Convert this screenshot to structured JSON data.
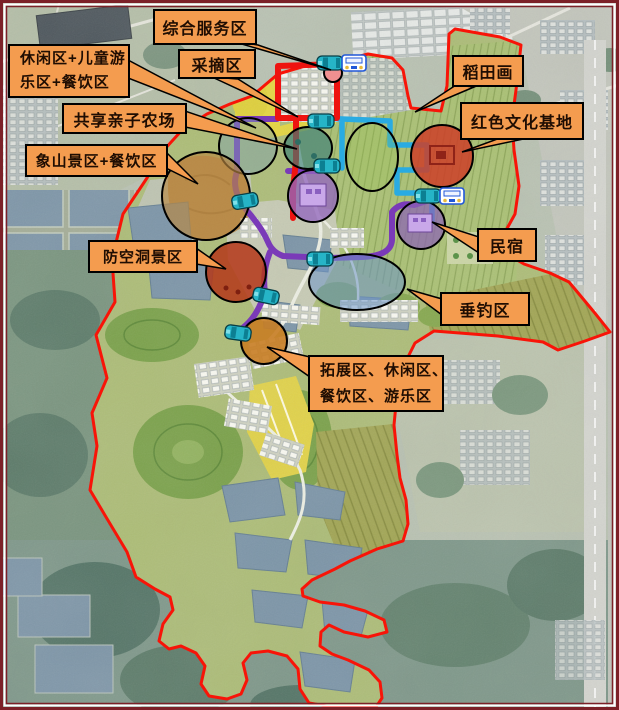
{
  "callouts": [
    {
      "id": "comprehensive-service-area",
      "lines": [
        "综合服务区"
      ]
    },
    {
      "id": "picking-area",
      "lines": [
        "采摘区"
      ]
    },
    {
      "id": "leisure-children-dining-area",
      "lines": [
        "休闲区+儿童游",
        "乐区+餐饮区"
      ]
    },
    {
      "id": "shared-family-farm",
      "lines": [
        "共享亲子农场"
      ]
    },
    {
      "id": "xiangshan-scenic-dining-area",
      "lines": [
        "象山景区+餐饮区"
      ]
    },
    {
      "id": "air-raid-shelter-scenic-area",
      "lines": [
        "防空洞景区"
      ]
    },
    {
      "id": "rice-paddy-art",
      "lines": [
        "稻田画"
      ]
    },
    {
      "id": "red-culture-base",
      "lines": [
        "红色文化基地"
      ]
    },
    {
      "id": "homestay",
      "lines": [
        "民宿"
      ]
    },
    {
      "id": "fishing-area",
      "lines": [
        "垂钓区"
      ]
    },
    {
      "id": "expansion-leisure-dining-amusement-area",
      "lines": [
        "拓展区、休闲区、",
        "餐饮区、游乐区"
      ]
    }
  ],
  "zones": [
    {
      "id": "service-node",
      "color": "#ef9090"
    },
    {
      "id": "leisure-children-dining",
      "color": "rgba(125,160,178,0.45)"
    },
    {
      "id": "shared-family-farm",
      "color": "rgba(58,128,118,0.65)"
    },
    {
      "id": "rice-paddy-art",
      "color": "rgba(150,195,80,0.25)"
    },
    {
      "id": "red-culture-base",
      "color": "rgba(205,62,40,0.85)"
    },
    {
      "id": "central-purple-zone",
      "color": "rgba(148,104,190,0.78)"
    },
    {
      "id": "homestay",
      "color": "rgba(140,100,180,0.72)"
    },
    {
      "id": "xiangshan-scenic",
      "color": "rgba(185,135,65,0.65)"
    },
    {
      "id": "air-raid-shelter",
      "color": "rgba(180,55,25,0.85)"
    },
    {
      "id": "fishing",
      "color": "rgba(110,150,200,0.55)"
    },
    {
      "id": "expansion",
      "color": "rgba(200,125,35,0.9)"
    }
  ],
  "routes": {
    "red": "#ee1310",
    "cyan": "#29abe2",
    "purple": "#7a3ab8"
  },
  "boundary_color": "#f81408",
  "frame_color": "#7c2128",
  "callout_style": {
    "background": "#f49c4f",
    "border": "#000000",
    "text": "#1f0d02"
  },
  "icons": [
    {
      "name": "shuttle-car-icon",
      "color": "#26b4c7"
    },
    {
      "name": "car-front-icon",
      "color": "#2057d8"
    }
  ]
}
